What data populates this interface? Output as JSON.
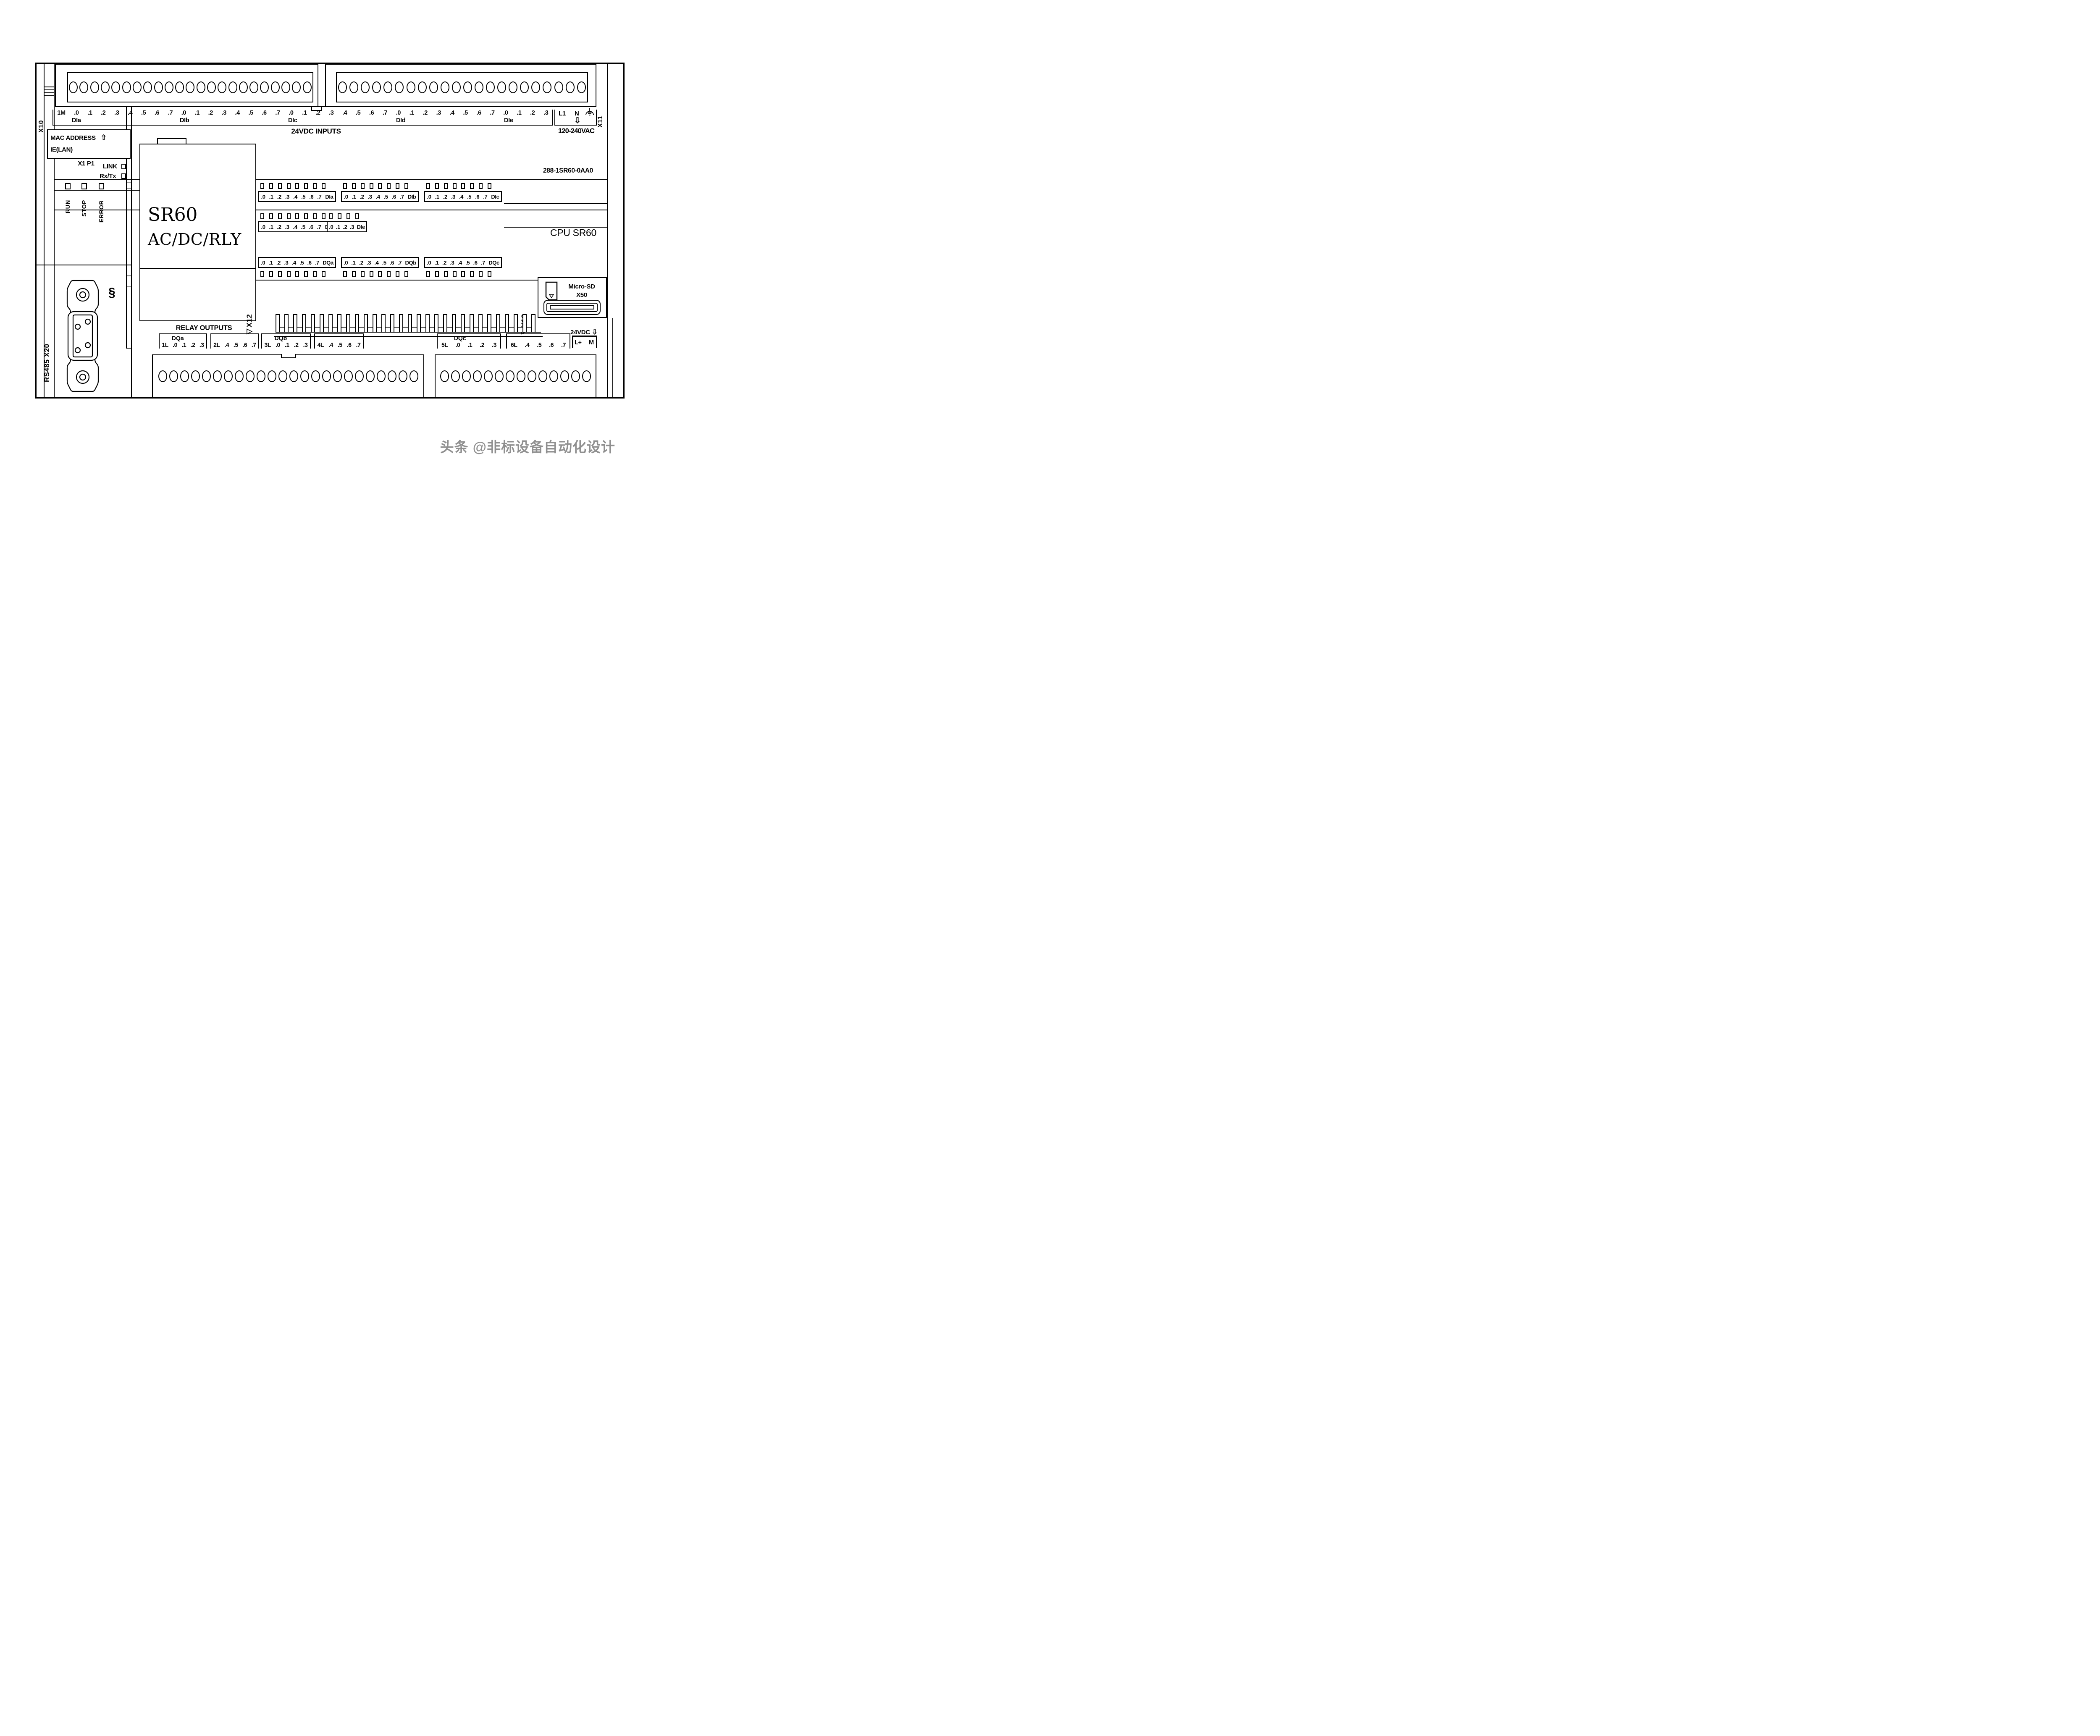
{
  "device": {
    "order_number": "288-1SR60-0AA0",
    "cpu_caption": "CPU SR60",
    "model": "SR60",
    "power_type": "AC/DC/RLY"
  },
  "ports": {
    "x10": "X10",
    "x11": "X11",
    "x12": "◁X12",
    "x13": "◁X13",
    "x1p1": "X1 P1",
    "rs485": "RS485 X20",
    "sd_line1": "Micro-SD",
    "sd_line2": "X50",
    "clip_icon": "§"
  },
  "mac": {
    "line1": "MAC ADDRESS",
    "arrow": "⇧",
    "line2": "IE(LAN)",
    "link": "LINK",
    "rxtx": "Rx/Tx"
  },
  "status_leds": [
    "RUN",
    "STOP",
    "ERROR"
  ],
  "inputs": {
    "first_terminal": "1M",
    "caption": "24VDC INPUTS",
    "groups": [
      {
        "name": "DIa",
        "labels": [
          ".0",
          ".1",
          ".2",
          ".3",
          ".4",
          ".5",
          ".6",
          ".7"
        ]
      },
      {
        "name": "DIb",
        "labels": [
          ".0",
          ".1",
          ".2",
          ".3",
          ".4",
          ".5",
          ".6",
          ".7"
        ]
      },
      {
        "name": "DIc",
        "labels": [
          ".0",
          ".1",
          ".2",
          ".3",
          ".4",
          ".5",
          ".6",
          ".7"
        ]
      },
      {
        "name": "DId",
        "labels": [
          ".0",
          ".1",
          ".2",
          ".3",
          ".4",
          ".5",
          ".6",
          ".7"
        ]
      },
      {
        "name": "DIe",
        "labels": [
          ".0",
          ".1",
          ".2",
          ".3"
        ]
      }
    ]
  },
  "power": {
    "labels": [
      "L1",
      "N"
    ],
    "caption": "120-240VAC",
    "arrow": "⇩",
    "earth_icon": "protective-earth"
  },
  "led_rows": {
    "dq": [
      {
        "name": "DQa",
        "labels": [
          ".0",
          ".1",
          ".2",
          ".3",
          ".4",
          ".5",
          ".6",
          ".7"
        ]
      },
      {
        "name": "DQb",
        "labels": [
          ".0",
          ".1",
          ".2",
          ".3",
          ".4",
          ".5",
          ".6",
          ".7"
        ]
      },
      {
        "name": "DQc",
        "labels": [
          ".0",
          ".1",
          ".2",
          ".3",
          ".4",
          ".5",
          ".6",
          ".7"
        ]
      }
    ]
  },
  "outputs": {
    "caption": "RELAY OUTPUTS",
    "groups": [
      {
        "name": "DQa",
        "labels": [
          "1L",
          ".0",
          ".1",
          ".2",
          ".3"
        ]
      },
      {
        "name": "",
        "labels": [
          "2L",
          ".4",
          ".5",
          ".6",
          ".7"
        ]
      },
      {
        "name": "DQb",
        "labels": [
          "3L",
          ".0",
          ".1",
          ".2",
          ".3"
        ]
      },
      {
        "name": "",
        "labels": [
          "4L",
          ".4",
          ".5",
          ".6",
          ".7"
        ]
      },
      {
        "name": "DQc",
        "labels": [
          "5L",
          ".0",
          ".1",
          ".2",
          ".3"
        ]
      },
      {
        "name": "",
        "labels": [
          "6L",
          ".4",
          ".5",
          ".6",
          ".7"
        ]
      }
    ],
    "sensor_supply": {
      "caption": "24VDC",
      "arrow": "⇩",
      "labels": [
        "L+",
        "M"
      ]
    }
  },
  "counts": {
    "top_left_terminals": 23,
    "top_right_terminals": 22,
    "bottom_left_terminals": 24,
    "bottom_right_terminals": 14,
    "comb_teeth": 30
  },
  "watermark": "头条 @非标设备自动化设计",
  "colors": {
    "line": "#000000",
    "watermark": "#8f8f8f",
    "tick": "#9a9a9a"
  }
}
